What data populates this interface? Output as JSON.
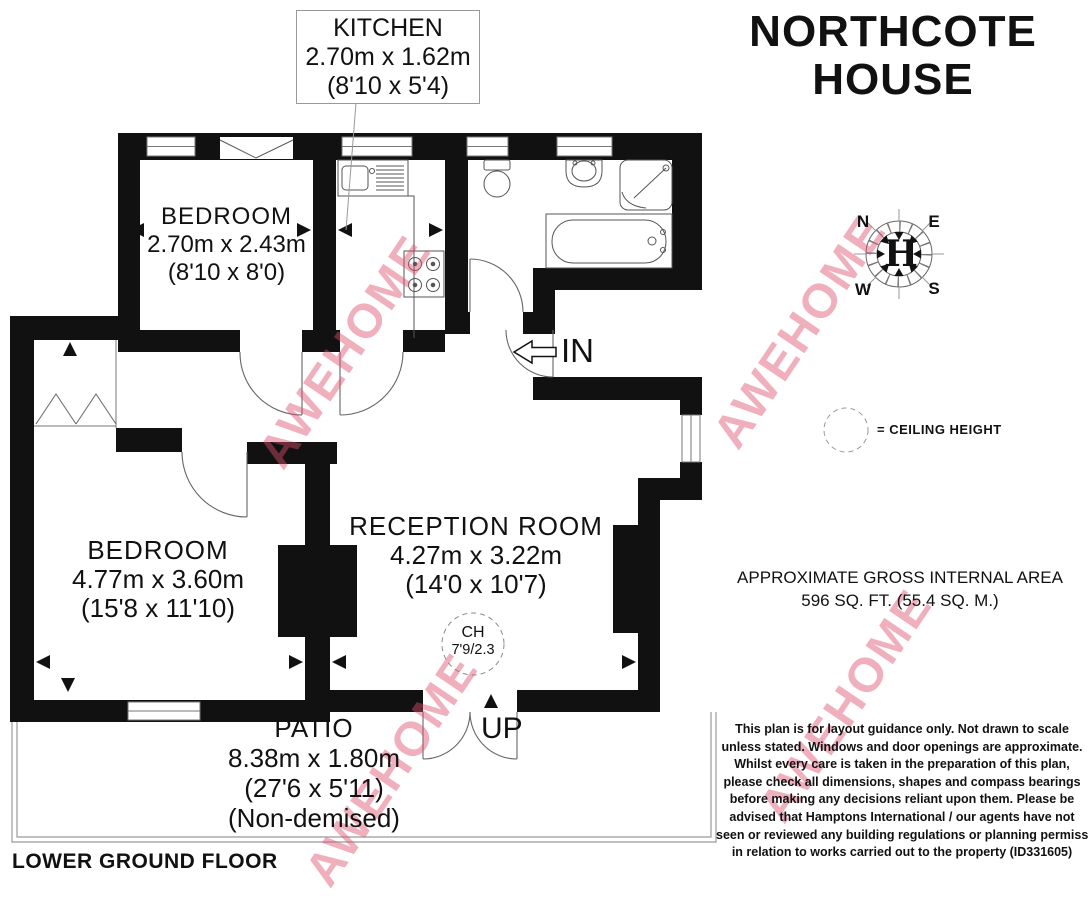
{
  "page": {
    "background": "#ffffff",
    "wall_color": "#111111"
  },
  "title": {
    "line1": "NORTHCOTE",
    "line2": "HOUSE"
  },
  "floor_label": "LOWER GROUND FLOOR",
  "watermark": {
    "text": "AWEHOME",
    "color": "rgba(222,77,109,0.45)"
  },
  "compass": {
    "north": "N",
    "east": "E",
    "south": "S",
    "west": "W",
    "monogram": "H"
  },
  "legend": {
    "ceiling_height_label": "= CEILING HEIGHT"
  },
  "area_summary": {
    "line1": "APPROXIMATE GROSS INTERNAL AREA",
    "line2": "596 SQ. FT. (55.4 SQ. M.)"
  },
  "rooms": {
    "kitchen": {
      "name": "KITCHEN",
      "metric": "2.70m x 1.62m",
      "imperial": "(8'10 x 5'4)"
    },
    "bedroom_top": {
      "name": "BEDROOM",
      "metric": "2.70m x 2.43m",
      "imperial": "(8'10 x 8'0)"
    },
    "bedroom_main": {
      "name": "BEDROOM",
      "metric": "4.77m x 3.60m",
      "imperial": "(15'8 x 11'10)"
    },
    "reception": {
      "name": "RECEPTION ROOM",
      "metric": "4.27m x 3.22m",
      "imperial": "(14'0 x 10'7)"
    },
    "patio": {
      "name": "PATIO",
      "metric": "8.38m x 1.80m",
      "imperial": "(27'6 x 5'11)",
      "note": "(Non-demised)"
    }
  },
  "annotations": {
    "entrance": "IN",
    "stairs": "UP",
    "ceiling_height_abbr": "CH",
    "ceiling_height_value": "7'9/2.3"
  },
  "disclaimer": {
    "lines": [
      "This plan is for layout guidance only. Not drawn to scale",
      "unless stated. Windows and door openings are approximate.",
      "Whilst every care is taken in the preparation of this plan,",
      "please check all dimensions, shapes and compass bearings",
      "before making any decisions reliant upon them. Please be",
      "advised that Hamptons International / our agents have not",
      "seen or reviewed any building regulations or planning permission",
      "in relation to works carried out to the property (ID331605)"
    ]
  }
}
